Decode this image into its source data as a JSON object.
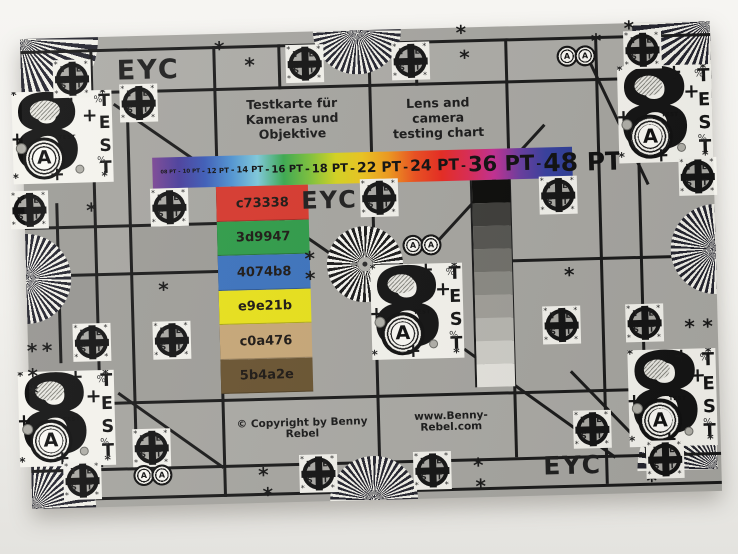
{
  "page": {
    "background_top": "#f6f5f2",
    "background_bottom": "#e4e3df"
  },
  "chart": {
    "base_color": "#a7a6a1",
    "line_color": "#1a1a1a",
    "labels": {
      "eyc_top_left": "EYC",
      "eyc_center": "EYC",
      "eyc_bottom_right": "EYC",
      "title_de_line1": "Testkarte für",
      "title_de_line2": "Kameras und Objektive",
      "title_en_line1": "Lens and camera",
      "title_en_line2": "testing chart",
      "copyright": "© Copyright by Benny Rebel",
      "website": "www.Benny-Rebel.com"
    },
    "font_size_bar": {
      "labels": [
        "08 PT",
        "10 PT",
        "12 PT",
        "14 PT",
        "16 PT",
        "18 PT",
        "22 PT",
        "24 PT",
        "36 PT",
        "48 PT"
      ],
      "separator": "-",
      "gradient_colors": [
        "#7c4795",
        "#4a3e9c",
        "#3c5cb8",
        "#4f93d2",
        "#7ec9dc",
        "#3aa94f",
        "#7dc23a",
        "#d6d41f",
        "#ecc51e",
        "#f0991c",
        "#ed4f1e",
        "#e92a20",
        "#dd2a52",
        "#c52f93",
        "#6a3da0",
        "#3740a0",
        "#2e3e96"
      ]
    },
    "color_swatches": [
      {
        "label": "c73338",
        "color": "#d8392e"
      },
      {
        "label": "3d9947",
        "color": "#2f9c49"
      },
      {
        "label": "4074b8",
        "color": "#3c73be"
      },
      {
        "label": "e9e21b",
        "color": "#e9e21b"
      },
      {
        "label": "c0a476",
        "color": "#c8a878"
      },
      {
        "label": "5b4a2e",
        "color": "#6a5431"
      }
    ],
    "grayscale_steps": [
      "#0c0c0a",
      "#3e3d3a",
      "#565551",
      "#71706a",
      "#8b8a84",
      "#a19f99",
      "#b8b7b1",
      "#cfcec8",
      "#e5e4de"
    ],
    "test_block": {
      "big_glyph": "8",
      "circle_letter": "A",
      "vertical_text": "TEST",
      "small_text": "TEST",
      "plus": "+",
      "percent": "%",
      "asterisk": "*"
    },
    "crosshair_letters": [
      "T",
      "E",
      "S",
      "T"
    ],
    "symbols": {
      "asterisk": "*"
    }
  }
}
